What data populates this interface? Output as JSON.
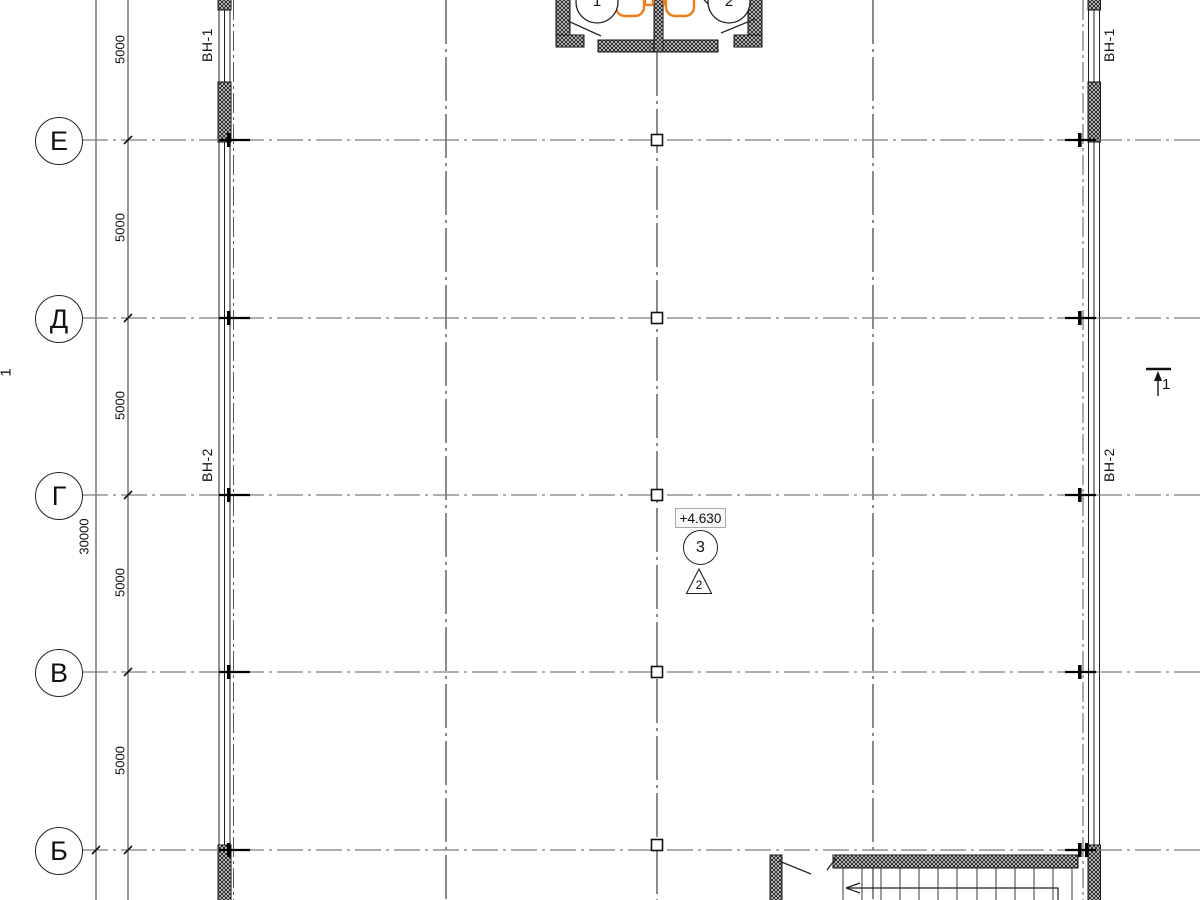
{
  "plan": {
    "row_axes": [
      {
        "label": "Е"
      },
      {
        "label": "Д"
      },
      {
        "label": "Г"
      },
      {
        "label": "В"
      },
      {
        "label": "Б"
      }
    ],
    "dims": {
      "bay": [
        "5000",
        "5000",
        "5000",
        "5000",
        "5000"
      ],
      "overall": "30000"
    },
    "window_tags": {
      "left_upper": "ВН-1",
      "left_lower": "ВН-2",
      "right_upper": "ВН-1",
      "right_lower": "ВН-2"
    },
    "annotations": {
      "elevation": "+4.630",
      "node": "3",
      "revision_triangle": "2",
      "section_left": "1",
      "section_right": "1",
      "entry_detail_left": "1",
      "entry_detail_right": "2"
    },
    "colors": {
      "fixture": "#F07D1A",
      "axis_line": "#7d7d7d",
      "grid_line": "#3c3c3c",
      "ink": "#1a1a1a"
    }
  }
}
